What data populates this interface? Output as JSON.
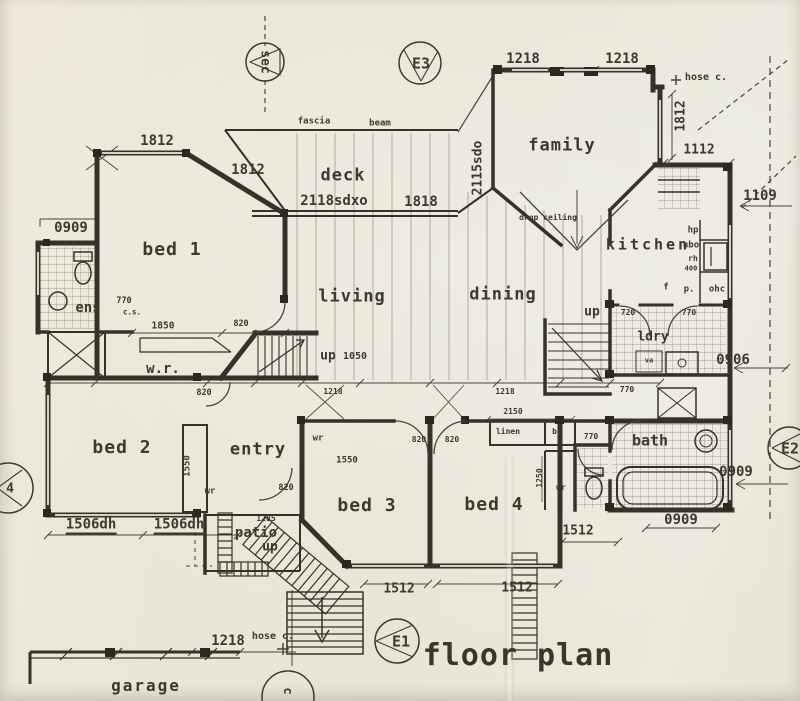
{
  "title": "floor plan",
  "markers": {
    "sec": "sec",
    "e3": "E3",
    "e1": "E1",
    "e2": "E2",
    "m4": "4",
    "mc": "c"
  },
  "rooms": {
    "bed1": "bed 1",
    "bed2": "bed 2",
    "bed3": "bed 3",
    "bed4": "bed 4",
    "living": "living",
    "dining": "dining",
    "family": "family",
    "deck": "deck",
    "kitchen": "kitchen",
    "entry": "entry",
    "patio": "patio",
    "garage": "garage",
    "bath": "bath",
    "ens": "ens",
    "wr_robe": "w.r.",
    "ldry": "ldry"
  },
  "annotations": {
    "fascia": "fascia",
    "beam": "beam",
    "drop_ceiling": "drop ceiling",
    "hose_c": "hose c.",
    "up": "up",
    "wr": "wr",
    "linen": "linen",
    "bc": "bc",
    "va": "va",
    "hp": "hp",
    "ubo": "ubo",
    "rh": "rh",
    "f": "f",
    "p": "p.",
    "ohc": "ohc",
    "cs": "c.s."
  },
  "dims": {
    "d1812": "1812",
    "d1218": "1218",
    "d1112": "1112",
    "d1109": "1109",
    "d0909": "0909",
    "d0906": "0906",
    "d2118sdxo": "2118sdxo",
    "d1818": "1818",
    "d2115sdo": "2115sdo",
    "d770": "770",
    "d1850": "1850",
    "d820": "820",
    "d1050": "1050",
    "d1550": "1550",
    "d1506dh": "1506dh",
    "d1285": "1285",
    "d2150": "2150",
    "d1250": "1250",
    "d720": "720",
    "d1512": "1512",
    "d400": "400"
  }
}
